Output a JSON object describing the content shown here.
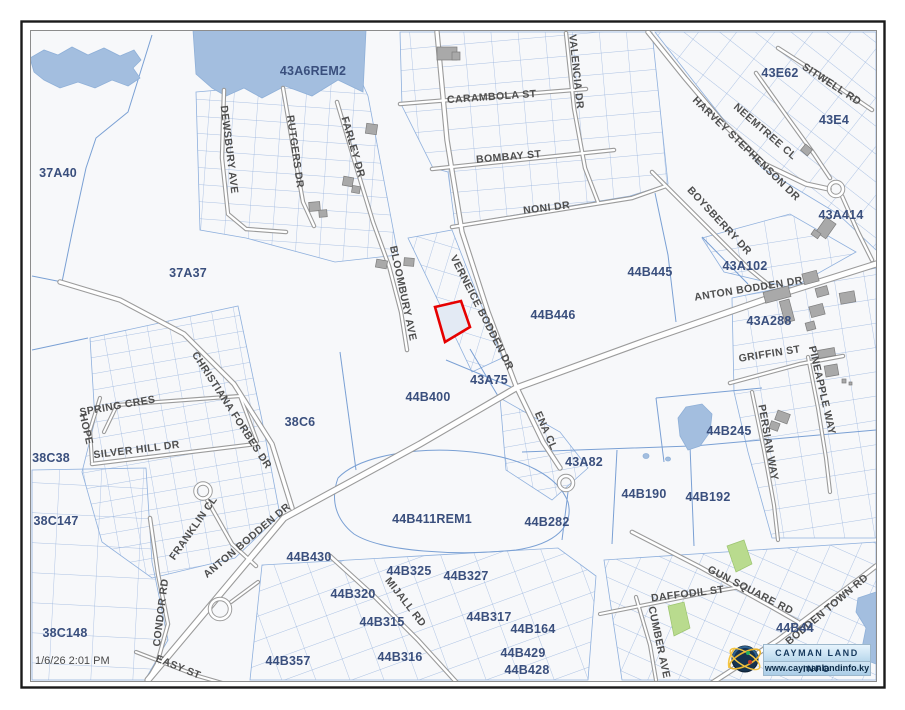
{
  "map": {
    "timestamp": "1/6/26 2:01 PM",
    "logo": {
      "title": "CAYMAN LAND INFO",
      "url": "www.caymanlandinfo.ky"
    },
    "colors": {
      "background": "#f7f8fa",
      "parcel_line": "#85a5d6",
      "road_casing": "#9b9b9b",
      "road_fill": "#ffffff",
      "water": "#a3bedf",
      "building": "#a9a9a9",
      "green_parcel": "#b9db8e",
      "highlight_outline": "#e60000",
      "parcel_label": "#3a4f7d",
      "road_label": "#4e4e4e"
    },
    "highlighted_parcel": {
      "points": "435,307 461,301 470,327 445,342"
    },
    "parcel_labels": [
      {
        "t": "43A6REM2",
        "x": 313,
        "y": 75
      },
      {
        "t": "43E62",
        "x": 780,
        "y": 77
      },
      {
        "t": "43E4",
        "x": 834,
        "y": 124
      },
      {
        "t": "37A40",
        "x": 58,
        "y": 177
      },
      {
        "t": "43A414",
        "x": 841,
        "y": 219
      },
      {
        "t": "37A37",
        "x": 188,
        "y": 277
      },
      {
        "t": "44B445",
        "x": 650,
        "y": 276
      },
      {
        "t": "43A102",
        "x": 745,
        "y": 270
      },
      {
        "t": "44B446",
        "x": 553,
        "y": 319
      },
      {
        "t": "43A288",
        "x": 769,
        "y": 325
      },
      {
        "t": "43A75",
        "x": 489,
        "y": 384
      },
      {
        "t": "44B400",
        "x": 428,
        "y": 401
      },
      {
        "t": "38C6",
        "x": 300,
        "y": 426
      },
      {
        "t": "38C38",
        "x": 51,
        "y": 462
      },
      {
        "t": "44B245",
        "x": 729,
        "y": 435
      },
      {
        "t": "43A82",
        "x": 584,
        "y": 466
      },
      {
        "t": "44B190",
        "x": 644,
        "y": 498
      },
      {
        "t": "44B192",
        "x": 708,
        "y": 501
      },
      {
        "t": "38C147",
        "x": 56,
        "y": 525
      },
      {
        "t": "44B411REM1",
        "x": 432,
        "y": 523
      },
      {
        "t": "44B282",
        "x": 547,
        "y": 526
      },
      {
        "t": "44B430",
        "x": 309,
        "y": 561
      },
      {
        "t": "44B325",
        "x": 409,
        "y": 575
      },
      {
        "t": "44B327",
        "x": 466,
        "y": 580
      },
      {
        "t": "44B320",
        "x": 353,
        "y": 598
      },
      {
        "t": "44B315",
        "x": 382,
        "y": 626
      },
      {
        "t": "44B317",
        "x": 489,
        "y": 621
      },
      {
        "t": "44B164",
        "x": 533,
        "y": 633
      },
      {
        "t": "38C148",
        "x": 65,
        "y": 637
      },
      {
        "t": "44B429",
        "x": 523,
        "y": 657
      },
      {
        "t": "44B316",
        "x": 400,
        "y": 661
      },
      {
        "t": "44B428",
        "x": 527,
        "y": 674
      },
      {
        "t": "44B357",
        "x": 288,
        "y": 665
      },
      {
        "t": "44B44",
        "x": 795,
        "y": 632
      }
    ],
    "road_labels": [
      {
        "t": "CARAMBOLA ST",
        "x": 492,
        "y": 100,
        "r": -4
      },
      {
        "t": "BOMBAY ST",
        "x": 509,
        "y": 160,
        "r": -5
      },
      {
        "t": "NONI DR",
        "x": 547,
        "y": 211,
        "r": -7
      },
      {
        "t": "VALENCIA DR",
        "x": 573,
        "y": 72,
        "r": 84
      },
      {
        "t": "DEWSBURY AVE",
        "x": 226,
        "y": 150,
        "r": 83
      },
      {
        "t": "RUTGERS DR",
        "x": 292,
        "y": 152,
        "r": 82
      },
      {
        "t": "FARLEY DR",
        "x": 350,
        "y": 148,
        "r": 74
      },
      {
        "t": "BLOOMBURY AVE",
        "x": 400,
        "y": 294,
        "r": 78
      },
      {
        "t": "VERNEICE BODDEN DR",
        "x": 479,
        "y": 314,
        "r": 63
      },
      {
        "t": "NEEMTREE CL",
        "x": 763,
        "y": 134,
        "r": 41
      },
      {
        "t": "HARVEY STEPHENSON DR",
        "x": 744,
        "y": 151,
        "r": 44
      },
      {
        "t": "SITWELL RD",
        "x": 830,
        "y": 87,
        "r": 33
      },
      {
        "t": "BOYSBERRY DR",
        "x": 717,
        "y": 223,
        "r": 47
      },
      {
        "t": "ANTON BODDEN DR",
        "x": 749,
        "y": 292,
        "r": -9
      },
      {
        "t": "ANTON BODDEN DR",
        "x": 249,
        "y": 543,
        "r": -40
      },
      {
        "t": "GRIFFIN ST",
        "x": 770,
        "y": 357,
        "r": -9
      },
      {
        "t": "PINEAPPLE WAY",
        "x": 819,
        "y": 391,
        "r": 77
      },
      {
        "t": "PERSIAN WAY",
        "x": 765,
        "y": 443,
        "r": 80
      },
      {
        "t": "CHRISTIANA FORBES DR",
        "x": 229,
        "y": 412,
        "r": 57
      },
      {
        "t": "ENA CL",
        "x": 543,
        "y": 432,
        "r": 66
      },
      {
        "t": "SPRING CRES",
        "x": 118,
        "y": 409,
        "r": -10
      },
      {
        "t": "SILVER HILL DR",
        "x": 137,
        "y": 453,
        "r": -7
      },
      {
        "t": "HOPE",
        "x": 83,
        "y": 430,
        "r": 77
      },
      {
        "t": "FRANKLIN CL",
        "x": 196,
        "y": 530,
        "r": -55
      },
      {
        "t": "CONDOR RD",
        "x": 164,
        "y": 613,
        "r": -83
      },
      {
        "t": "EASY ST",
        "x": 177,
        "y": 670,
        "r": 22
      },
      {
        "t": "MIJALL RD",
        "x": 403,
        "y": 604,
        "r": 52
      },
      {
        "t": "GUN SQUARE RD",
        "x": 749,
        "y": 593,
        "r": 27
      },
      {
        "t": "DAFFODIL ST",
        "x": 688,
        "y": 597,
        "r": -7
      },
      {
        "t": "CUMBER AVE",
        "x": 656,
        "y": 643,
        "r": 78
      },
      {
        "t": "BODDEN TOWN RD",
        "x": 829,
        "y": 612,
        "r": -40
      }
    ]
  }
}
